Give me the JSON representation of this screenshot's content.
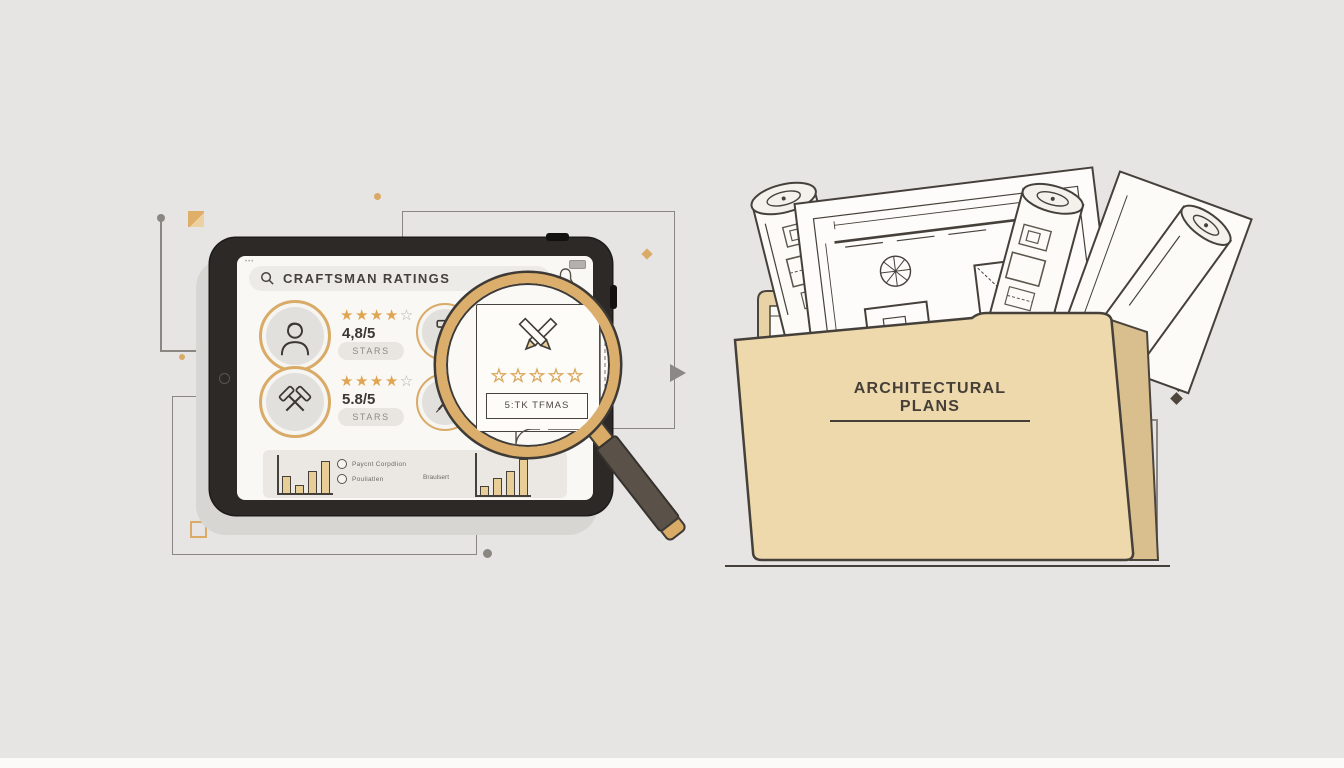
{
  "scene": {
    "background_color": "#e7e5e3",
    "accent_gold": "#dcae6b",
    "ink_color": "#3e3a35",
    "folder_tan": "#eed9ad"
  },
  "tablet": {
    "status": {
      "dots": "•••"
    },
    "search_bar": {
      "icon": "search",
      "label": "CRAFTSMAN RATINGS"
    },
    "ratings": [
      {
        "avatar_icon": "person",
        "stars_filled": "★★★★",
        "star_empty": "☆",
        "score": "4,8/5",
        "button_label": "STARS"
      },
      {
        "avatar_icon": "crossed-hammers",
        "stars_filled": "★★★★",
        "star_empty": "☆",
        "score": "5.8/5",
        "button_label": "STARS"
      }
    ],
    "tool_circles": [
      {
        "icon": "mallet"
      },
      {
        "icon": "chisel"
      }
    ],
    "chart_panel": {
      "left_chart_bars": [
        45,
        22,
        58,
        85
      ],
      "right_chart_bars": [
        22,
        40,
        58,
        85
      ],
      "options": [
        {
          "label": "Paycnt Corpdlion"
        },
        {
          "label": "Pouliatlen"
        }
      ],
      "note": "Braulsert"
    }
  },
  "magnifier": {
    "card": {
      "icon": "crossed-pencils",
      "stars": "☆☆☆☆☆",
      "caption": "5:TK TFMAS"
    }
  },
  "folder": {
    "label": "ARCHITECTURAL PLANS"
  }
}
